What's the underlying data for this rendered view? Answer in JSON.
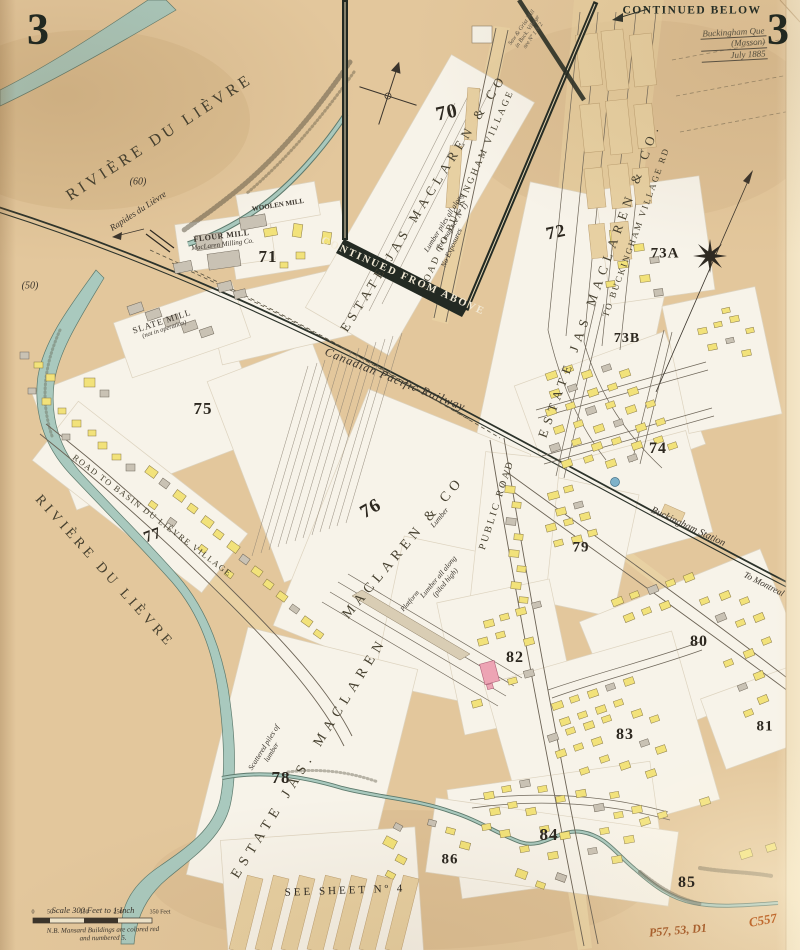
{
  "map": {
    "sheet_number": "3",
    "continued_below": "CONTINUED BELOW",
    "continued_from_above": "CONTINUED FROM ABOVE",
    "see_sheet_note": "SEE SHEET Nº 4",
    "stamp": {
      "line1": "Buckingham Que",
      "line2": "(Masson)",
      "line3": "July 1885"
    },
    "handwritten_refs": {
      "ref1": "P57, 53, D1",
      "ref2": "C557"
    },
    "note_top": {
      "line1": "Saw & Grist Mill",
      "line2": "in Buck. Village",
      "line3": "see Nº 1 & 2"
    }
  },
  "water": {
    "river_label_upper": "RIVIÈRE DU LIÈVRE",
    "river_label_lower": "RIVIÈRE DU LIÈVRE",
    "rapids_label": "Rapides du Lièvre",
    "elevation_60": "(60)",
    "elevation_50": "(50)"
  },
  "railway": {
    "main_label": "Canadian Pacific Railway",
    "station_label": "Buckingham Station",
    "direction_label": "To Montreal"
  },
  "roads": {
    "road_to_buckingham": "ROAD TO BUCKINGHAM VILLAGE",
    "to_buckingham_village_rd": "TO BUCKINGHAM VILLAGE RD",
    "public_road": "PUBLIC ROAD",
    "basin_road": "ROAD TO BASIN DU LIÈVRE VILLAGE"
  },
  "estates": {
    "block70": "ESTATE JAS MACLAREN & CO",
    "block72": "ESTATE JAS MACLAREN & CO.",
    "block76": "MACLAREN & CO",
    "block78": "ESTATE JAS. MACLAREN"
  },
  "mills": {
    "flour_mill": "FLOUR MILL",
    "flour_mill_sub": "MacLaren Milling Co.",
    "woolen_mill": "WOOLEN MILL",
    "slate_mill": "SLATE MILL",
    "slate_mill_sub": "(not in operation)"
  },
  "annotations": {
    "lumber_line1": "Lumber piles all along",
    "lumber_line2": "(for map see Nº 1)",
    "no_exposures": "No Exposures",
    "lumber": "Lumber",
    "lumber_all_along": "Lumber all along",
    "piled_high": "(piled high)",
    "platform": "Platform",
    "scattered_line1": "Scattered piles of",
    "scattered_line2": "lumber"
  },
  "blocks": {
    "b70": "70",
    "b71": "71",
    "b72": "72",
    "b73a": "73A",
    "b73b": "73B",
    "b74": "74",
    "b75": "75",
    "b76": "76",
    "b77": "77",
    "b78": "78",
    "b79": "79",
    "b80": "80",
    "b81": "81",
    "b82": "82",
    "b83": "83",
    "b84": "84",
    "b85": "85",
    "b86": "86"
  },
  "scale": {
    "title": "Scale 300 Feet to 1 Inch",
    "ticks": [
      "0",
      "50",
      "150",
      "250",
      "350 Feet"
    ],
    "note_line1": "N.B. Mansard Buildings are colored red",
    "note_line2": "and numbered 5."
  },
  "colors": {
    "paper": "#e3c79c",
    "slip": "#f7f3e9",
    "water": "#a9c9be",
    "building_wood": "#f2e27a",
    "building_stone": "#c9c2b4",
    "building_special": "#eda4b4",
    "ink": "#3a342c",
    "boundary": "#232a23",
    "reference": "#b5622c"
  }
}
